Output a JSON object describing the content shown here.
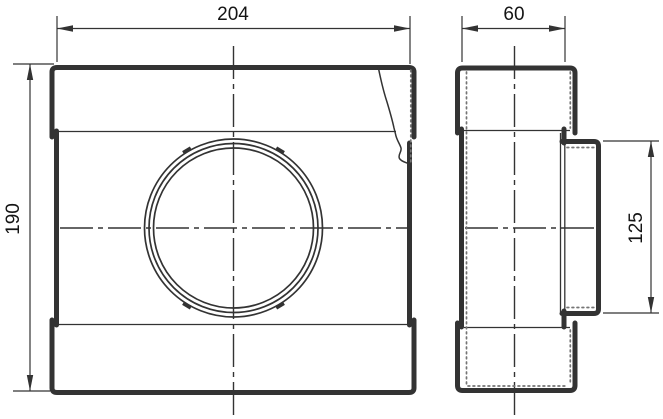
{
  "drawing": {
    "dimension_labels": {
      "width": "204",
      "depth": "60",
      "height": "190",
      "branch_diameter": "125"
    },
    "colors": {
      "line": "#333333",
      "text": "#141414",
      "background": "#ffffff",
      "dots": "#757575"
    }
  }
}
